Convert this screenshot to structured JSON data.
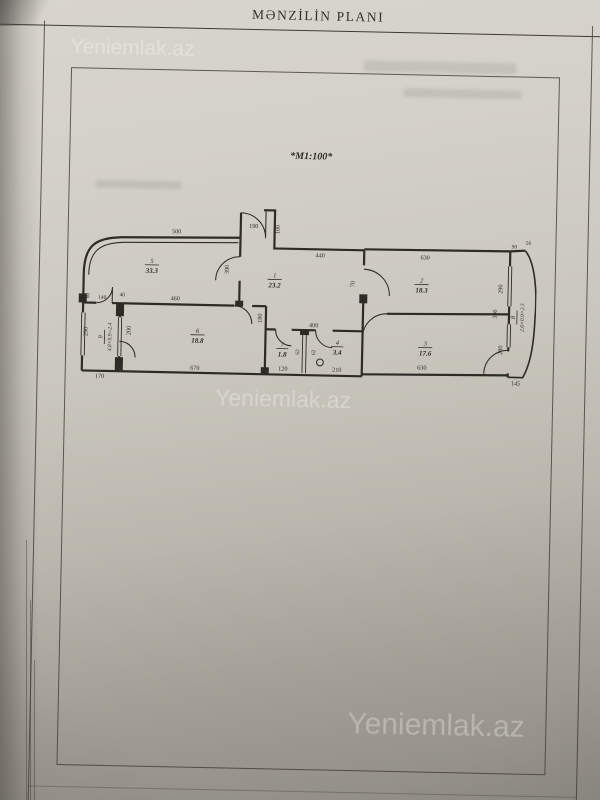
{
  "page": {
    "title": "MƏNZİLİN PLANI",
    "watermark": "Yeniemlak.az"
  },
  "plan": {
    "scale_note": "*M1:100*",
    "rooms": [
      {
        "number": "5",
        "area": "33.3"
      },
      {
        "number": "1",
        "area": "23.2"
      },
      {
        "number": "2",
        "area": "18.3"
      },
      {
        "number": "3",
        "area": "17.6"
      },
      {
        "number": "6",
        "area": "18.8"
      },
      {
        "number": "7",
        "area": "1.8"
      },
      {
        "number": "4",
        "area": "3.4"
      },
      {
        "number": "9",
        "area": "4.8×0.9=2.4"
      },
      {
        "number": "8",
        "area": "2.6×0.9=2.3"
      }
    ],
    "dims": {
      "room5_top": "500",
      "entry_door": "190",
      "entry_side": "100",
      "hall_top": "440",
      "room2_top": "630",
      "balcony_top": "90",
      "balcony_top2": "56",
      "room2_right": "290",
      "room5_right": "390",
      "hall_room2_door": "70",
      "room5_bottom": "460",
      "door_140": "140",
      "door_40": "40",
      "left_top": "60",
      "left_wall": "290",
      "room6_column": "200",
      "left_bottom": "170",
      "room6_bottom": "670",
      "wc_bottom": "120",
      "bath_bottom": "210",
      "wc_top": "400",
      "hall_side": "180",
      "gap_a": "62",
      "gap_b": "62",
      "room3_bottom": "630",
      "room3_right": "280",
      "balcony_side": "390",
      "balcony_bottom": "145"
    }
  }
}
